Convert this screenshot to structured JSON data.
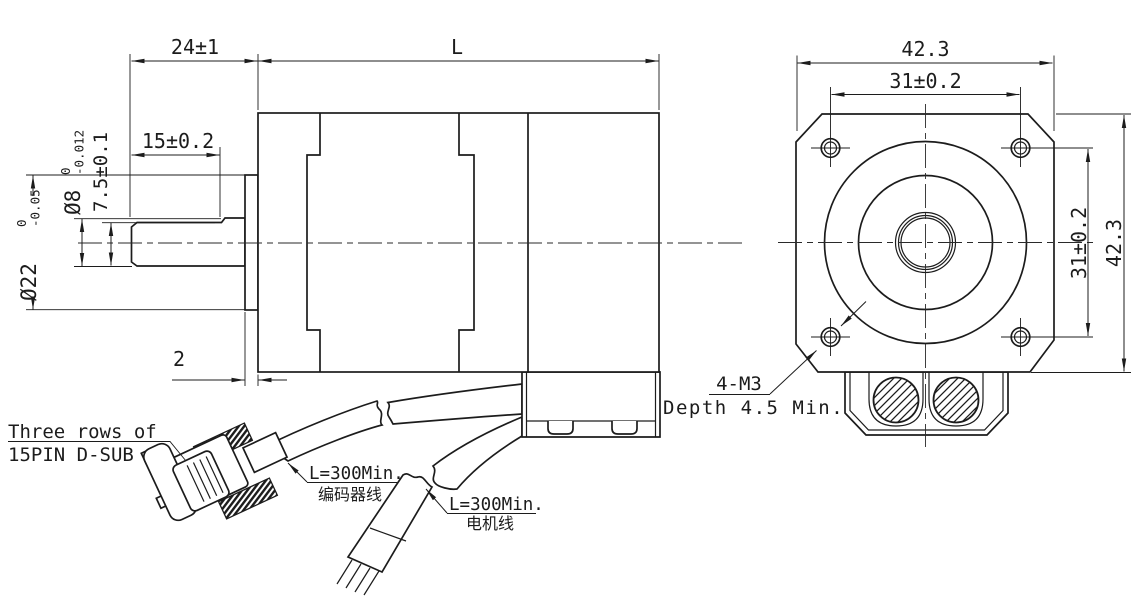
{
  "drawing": {
    "title": "stepper-motor-with-encoder-outline-drawing",
    "colors": {
      "line": "#1c1c1c",
      "background": "#ffffff"
    },
    "side_view": {
      "dim_shaft_section": "24±1",
      "dim_body_length": "L",
      "dim_flat_length": "15±0.2",
      "dim_flat_height": "7.5±0.1",
      "shaft_dia": {
        "nominal": "Ø8",
        "tol_upper": "0",
        "tol_lower": "-0.012"
      },
      "pilot_dia": {
        "nominal": "Ø22",
        "tol_upper": "0",
        "tol_lower": "-0.05"
      },
      "dim_pilot_depth": "2"
    },
    "front_view": {
      "dim_overall_width": "42.3",
      "dim_hole_spacing_top": "31±0.2",
      "dim_hole_spacing_right": "31±0.2",
      "dim_overall_height": "42.3",
      "mounting_note": {
        "line1": "4-M3",
        "line2": "Depth 4.5 Min."
      }
    },
    "labels": {
      "dsub": {
        "line1": "Three rows of",
        "line2": "15PIN D-SUB"
      },
      "encoder_cable": {
        "line1": "L=300Min.",
        "line2": "编码器线"
      },
      "motor_cable": {
        "line1": "L=300Min.",
        "line2": "电机线"
      }
    }
  }
}
